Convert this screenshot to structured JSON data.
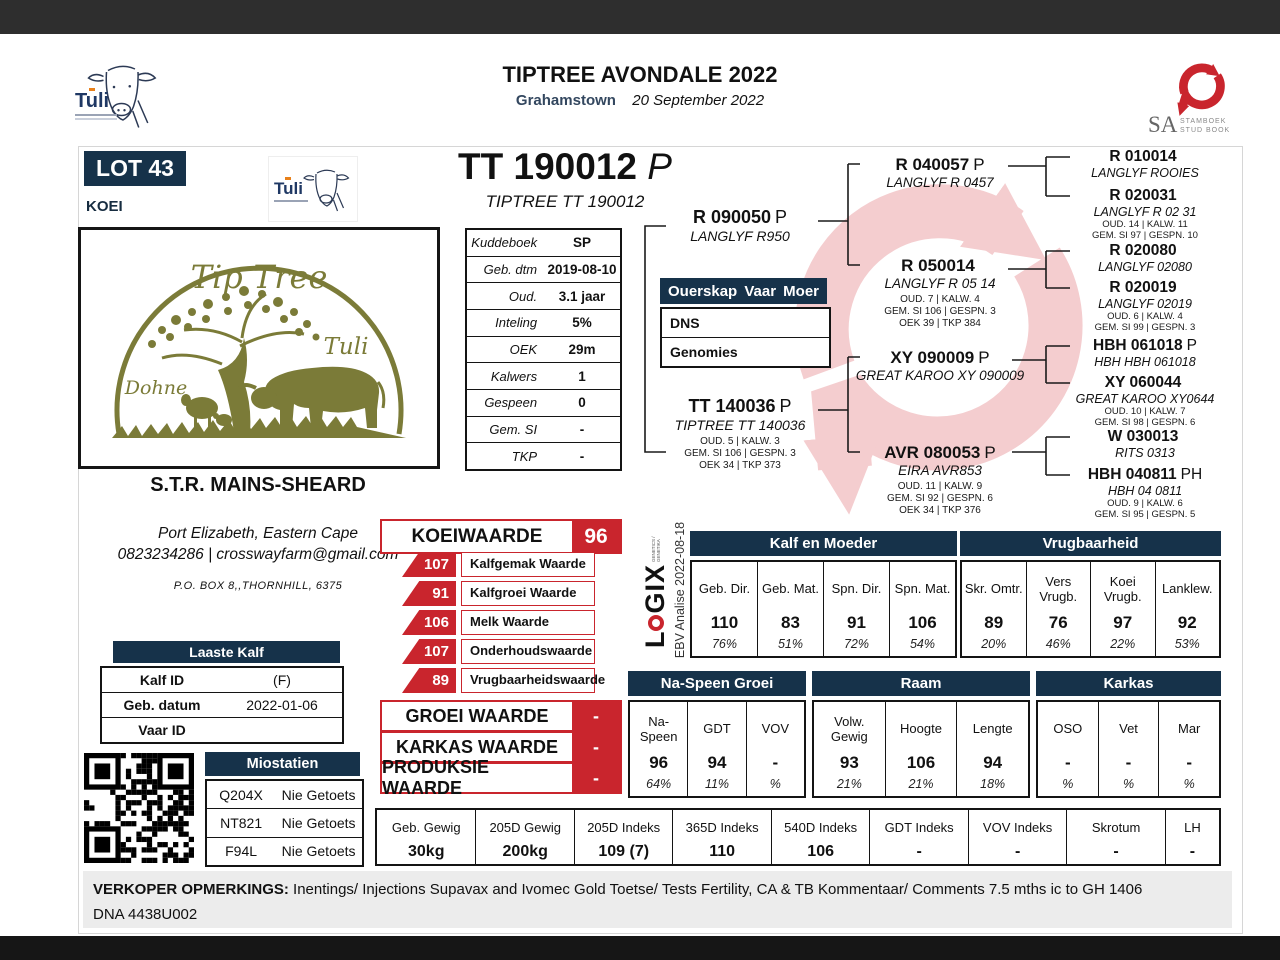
{
  "header": {
    "title": "TIPTREE AVONDALE 2022",
    "location": "Grahamstown",
    "date": "20 September 2022"
  },
  "logos": {
    "tuli": "Tuli",
    "sa": "SA",
    "sa_line1": "STAMBOEK",
    "sa_line2": "STUD BOOK",
    "logix_l": "L",
    "logix_gix": "GIX",
    "logix_sub": "GENETICS / GENETIKA",
    "ebv_analise": "EBV Analise 2022-08-18",
    "farm": {
      "name": "Tip Tree",
      "right": "Tuli",
      "left": "Dohne"
    }
  },
  "lot": {
    "number": "LOT 43",
    "sex": "KOEI",
    "id": "TT 190012",
    "suffix": "P",
    "full_name": "TIPTREE TT 190012"
  },
  "info": {
    "rows": [
      {
        "label": "Kuddeboek",
        "value": "SP"
      },
      {
        "label": "Geb. dtm",
        "value": "2019-08-10"
      },
      {
        "label": "Oud.",
        "value": "3.1 jaar"
      },
      {
        "label": "Inteling",
        "value": "5%"
      },
      {
        "label": "OEK",
        "value": "29m"
      },
      {
        "label": "Kalwers",
        "value": "1"
      },
      {
        "label": "Gespeen",
        "value": "0"
      },
      {
        "label": "Gem. SI",
        "value": "-"
      },
      {
        "label": "TKP",
        "value": "-"
      }
    ]
  },
  "ouerskap": {
    "title": "Ouerskap",
    "col_vaar": "Vaar",
    "col_moer": "Moer",
    "rows": [
      {
        "label": "DNS"
      },
      {
        "label": "Genomies"
      }
    ]
  },
  "owner": {
    "name": "S.T.R. MAINS-SHEARD",
    "location": "Port Elizabeth, Eastern Cape",
    "contact": "0823234286 | crosswayfarm@gmail.com",
    "address": "P.O. BOX 8,,THORNHILL, 6375"
  },
  "pedigree": {
    "sire": {
      "id": "R 090050",
      "suffix": "P",
      "name": "LANGLYF R950"
    },
    "dam": {
      "id": "TT 140036",
      "suffix": "P",
      "name": "TIPTREE TT 140036",
      "stats": [
        "OUD. 5 | KALW. 3",
        "GEM. SI 106 | GESPN. 3",
        "OEK 34 | TKP 373"
      ]
    },
    "gen3": [
      {
        "id": "R 040057",
        "suffix": "P",
        "name": "LANGLYF R 0457"
      },
      {
        "id": "R 050014",
        "suffix": "",
        "name": "LANGLYF R 05 14",
        "stats": [
          "OUD. 7 | KALW. 4",
          "GEM. SI 106 | GESPN. 3",
          "OEK 39 | TKP 384"
        ]
      },
      {
        "id": "XY 090009",
        "suffix": "P",
        "name": "GREAT KAROO XY 090009"
      },
      {
        "id": "AVR 080053",
        "suffix": "P",
        "name": "EIRA AVR853",
        "stats": [
          "OUD. 11 | KALW. 9",
          "GEM. SI 92 | GESPN. 6",
          "OEK 34 | TKP 376"
        ]
      }
    ],
    "gen4": [
      {
        "id": "R 010014",
        "suffix": "",
        "name": "LANGLYF ROOIES"
      },
      {
        "id": "R 020031",
        "suffix": "",
        "name": "LANGLYF R 02 31",
        "stats": [
          "OUD. 14 | KALW. 11",
          "GEM. SI 97 | GESPN. 10"
        ]
      },
      {
        "id": "R 020080",
        "suffix": "",
        "name": "LANGLYF 02080"
      },
      {
        "id": "R 020019",
        "suffix": "",
        "name": "LANGLYF 02019",
        "stats": [
          "OUD. 6 | KALW. 4",
          "GEM. SI 99 | GESPN. 3"
        ]
      },
      {
        "id": "HBH 061018",
        "suffix": "P",
        "name": "HBH HBH 061018"
      },
      {
        "id": "XY 060044",
        "suffix": "",
        "name": "GREAT KAROO XY0644",
        "stats": [
          "OUD. 10 | KALW. 7",
          "GEM. SI 98 | GESPN. 6"
        ]
      },
      {
        "id": "W 030013",
        "suffix": "",
        "name": "RITS 0313"
      },
      {
        "id": "HBH 040811",
        "suffix": "PH",
        "name": "HBH 04 0811",
        "stats": [
          "OUD. 9 | KALW. 6",
          "GEM. SI 95 | GESPN. 5"
        ]
      }
    ]
  },
  "koeiwaarde": {
    "label": "KOEIWAARDE",
    "value": "96",
    "items": [
      {
        "value": "107",
        "label": "Kalfgemak Waarde"
      },
      {
        "value": "91",
        "label": "Kalfgroei Waarde"
      },
      {
        "value": "106",
        "label": "Melk Waarde"
      },
      {
        "value": "107",
        "label": "Onderhoudswaarde"
      },
      {
        "value": "89",
        "label": "Vrugbaarheidswaarde"
      }
    ],
    "groups": [
      {
        "label": "GROEI WAARDE",
        "value": "-"
      },
      {
        "label": "KARKAS WAARDE",
        "value": "-"
      },
      {
        "label": "PRODUKSIE WAARDE",
        "value": "-"
      }
    ]
  },
  "laaste_kalf": {
    "title": "Laaste Kalf",
    "rows": [
      {
        "label": "Kalf ID",
        "value": "(F)"
      },
      {
        "label": "Geb. datum",
        "value": "2022-01-06"
      },
      {
        "label": "Vaar ID",
        "value": ""
      }
    ]
  },
  "miostatien": {
    "title": "Miostatien",
    "rows": [
      {
        "label": "Q204X",
        "value": "Nie Getoets"
      },
      {
        "label": "NT821",
        "value": "Nie Getoets"
      },
      {
        "label": "F94L",
        "value": "Nie Getoets"
      }
    ]
  },
  "ebv": {
    "top": [
      {
        "title": "Kalf en Moeder",
        "cols": [
          {
            "h": "Geb. Dir.",
            "v": "110",
            "a": "76%"
          },
          {
            "h": "Geb. Mat.",
            "v": "83",
            "a": "51%"
          },
          {
            "h": "Spn. Dir.",
            "v": "91",
            "a": "72%"
          },
          {
            "h": "Spn. Mat.",
            "v": "106",
            "a": "54%"
          }
        ]
      },
      {
        "title": "Vrugbaarheid",
        "cols": [
          {
            "h": "Skr. Omtr.",
            "v": "89",
            "a": "20%"
          },
          {
            "h": "Vers Vrugb.",
            "v": "76",
            "a": "46%"
          },
          {
            "h": "Koei Vrugb.",
            "v": "97",
            "a": "22%"
          },
          {
            "h": "Lanklew.",
            "v": "92",
            "a": "53%"
          }
        ]
      }
    ],
    "mid": [
      {
        "title": "Na-Speen Groei",
        "cols": [
          {
            "h": "Na-Speen",
            "v": "96",
            "a": "64%"
          },
          {
            "h": "GDT",
            "v": "94",
            "a": "11%"
          },
          {
            "h": "VOV",
            "v": "-",
            "a": "%"
          }
        ]
      },
      {
        "title": "Raam",
        "cols": [
          {
            "h": "Volw. Gewig",
            "v": "93",
            "a": "21%"
          },
          {
            "h": "Hoogte",
            "v": "106",
            "a": "21%"
          },
          {
            "h": "Lengte",
            "v": "94",
            "a": "18%"
          }
        ]
      },
      {
        "title": "Karkas",
        "cols": [
          {
            "h": "OSO",
            "v": "-",
            "a": "%"
          },
          {
            "h": "Vet",
            "v": "-",
            "a": "%"
          },
          {
            "h": "Mar",
            "v": "-",
            "a": "%"
          }
        ]
      }
    ],
    "bottom": [
      {
        "h": "Geb. Gewig",
        "v": "30kg"
      },
      {
        "h": "205D Gewig",
        "v": "200kg"
      },
      {
        "h": "205D Indeks",
        "v": "109 (7)"
      },
      {
        "h": "365D Indeks",
        "v": "110"
      },
      {
        "h": "540D Indeks",
        "v": "106"
      },
      {
        "h": "GDT Indeks",
        "v": "-"
      },
      {
        "h": "VOV Indeks",
        "v": "-"
      },
      {
        "h": "Skrotum",
        "v": "-"
      },
      {
        "h": "LH",
        "v": "-"
      }
    ]
  },
  "remarks": {
    "label": "VERKOPER OPMERKINGS:",
    "line1": "Inentings/ Injections Supavax and Ivomec Gold Toetse/ Tests Fertility, CA & TB Kommentaar/ Comments 7.5 mths ic to GH 1406",
    "line2": "DNA 4438U002"
  }
}
